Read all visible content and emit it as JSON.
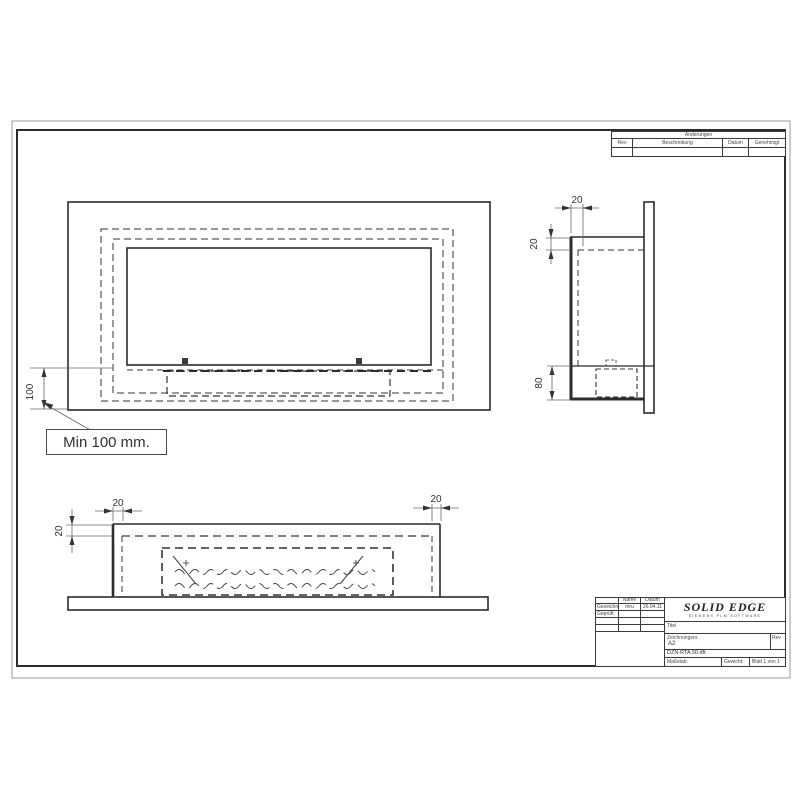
{
  "sheet": {
    "revision_table": {
      "title": "Änderungen",
      "col_rev": "Rev",
      "col_desc": "Beschreibung",
      "col_date": "Datum",
      "col_approved": "Genehmigt"
    },
    "title_block": {
      "name_header": "Name",
      "date_header": "Datum",
      "drawn_label": "Gezeichnet",
      "drawn_name": "mru",
      "drawn_date": "26.04.11",
      "checked_label": "Geprüft",
      "logo": "SOLID EDGE",
      "logo_sub": "SIEMENS PLM SOFTWARE",
      "title_label": "Titel",
      "drawing_no_label": "Zeichnungsnr.",
      "size_value": "A2",
      "rev_label": "Rev",
      "file_name": "DZN-RTA 50.dft",
      "scale_label": "Maßstab:",
      "weight_label": "Gewicht:",
      "sheet_label": "Blatt 1 von 1"
    },
    "callout": {
      "text": "Min 100 mm."
    },
    "dimensions": {
      "front_height": "100",
      "side_flange": "20",
      "side_top": "20",
      "side_burner": "80",
      "plan_left": "20",
      "plan_right": "20",
      "plan_depth": "20"
    }
  }
}
